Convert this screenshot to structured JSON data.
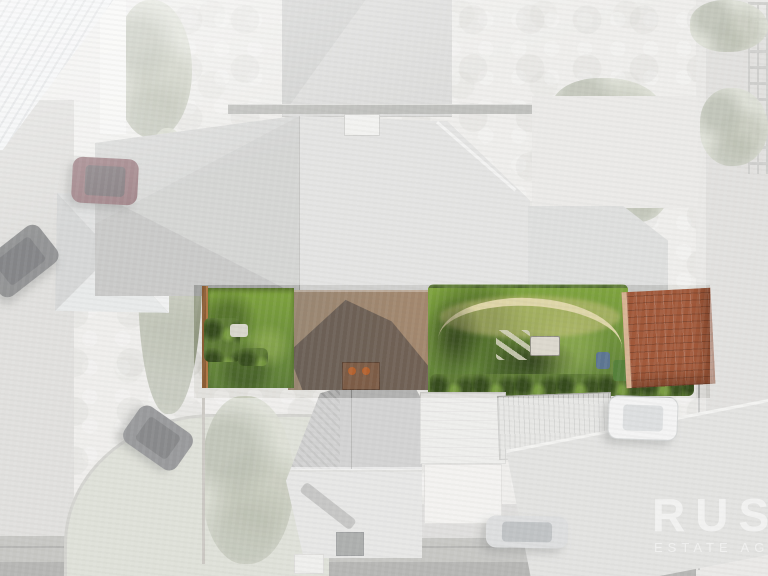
{
  "scene": {
    "kind": "aerial drone photograph, top-down view",
    "highlight": "central property and its gardens shown in full colour while surrounding houses, roads and cars are faded toward white",
    "objects": [
      "white corrugated roof top-left",
      "pyramid hip-roof house left",
      "large grey tiled roof of main house with white chimney",
      "rear extension roof with brick chimney and terracotta pots",
      "left lawn with timber fence and bright bushes",
      "right garden with curved stone path, garden table and tree shadows",
      "terracotta tiled garage roof",
      "four wheelie bins (blue, green, black, red)",
      "bottom house with two-tone tiled roof and dark chimney",
      "white garage and conservatory",
      "corrugated carport roof",
      "maroon car",
      "two dark cars",
      "white car",
      "silver car",
      "curved road bottom-left",
      "road along bottom edge",
      "driveway right edge with trellis"
    ]
  },
  "watermark": {
    "brand": "RUSH",
    "tagline": "ESTATE AGENCY"
  },
  "palette": {
    "base": "#e2e1dd",
    "lawn_green": "#5d7d38",
    "lawn_bright": "#7ea33d",
    "hedge_green": "#5d7a34",
    "fence_brown": "#b07845",
    "terracotta": "#a2593a",
    "terracotta_pot": "#b4612e",
    "car_maroon": "#5e2e36",
    "car_white": "#e9eaea",
    "car_silver": "#c2c4c6"
  }
}
